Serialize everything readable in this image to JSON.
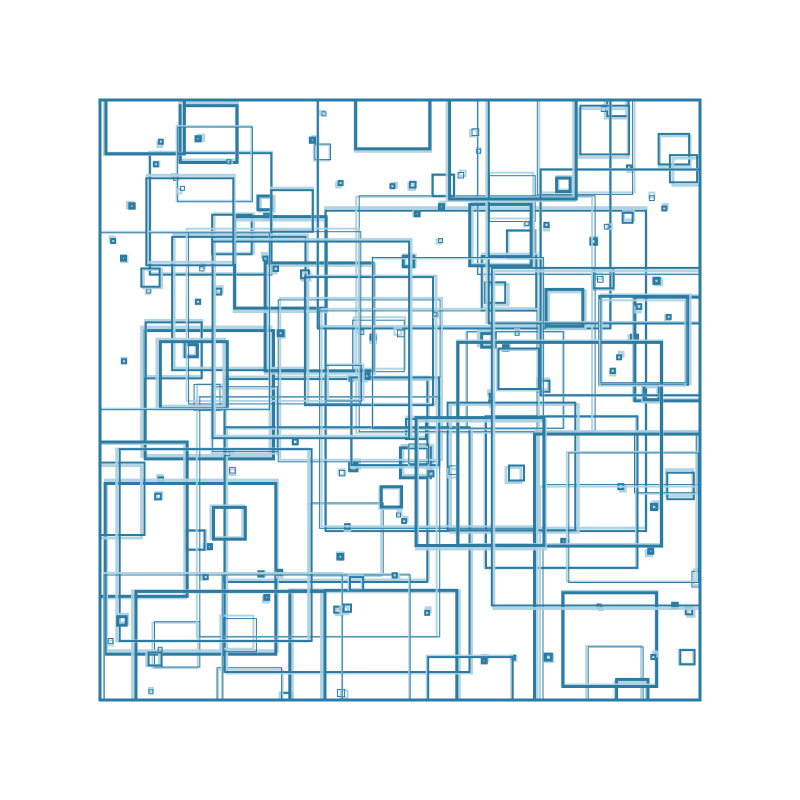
{
  "art": {
    "canvas": {
      "width": 800,
      "height": 800,
      "background": "#ffffff"
    },
    "frame": {
      "x": 100,
      "y": 100,
      "size": 600,
      "stroke_color": "#2b7ba3",
      "stroke_width": 3
    },
    "squares": {
      "seed": 1337,
      "count": 195,
      "min_size": 4,
      "max_size": 340,
      "size_exponent": 5,
      "stroke_color": "#2b7ba3",
      "stroke_widths": [
        1,
        2,
        3
      ],
      "echo_color": "#abd0e0",
      "echo_opacity": 0.9,
      "echo_extra_width": 1,
      "echo_max_offset": 3
    }
  }
}
